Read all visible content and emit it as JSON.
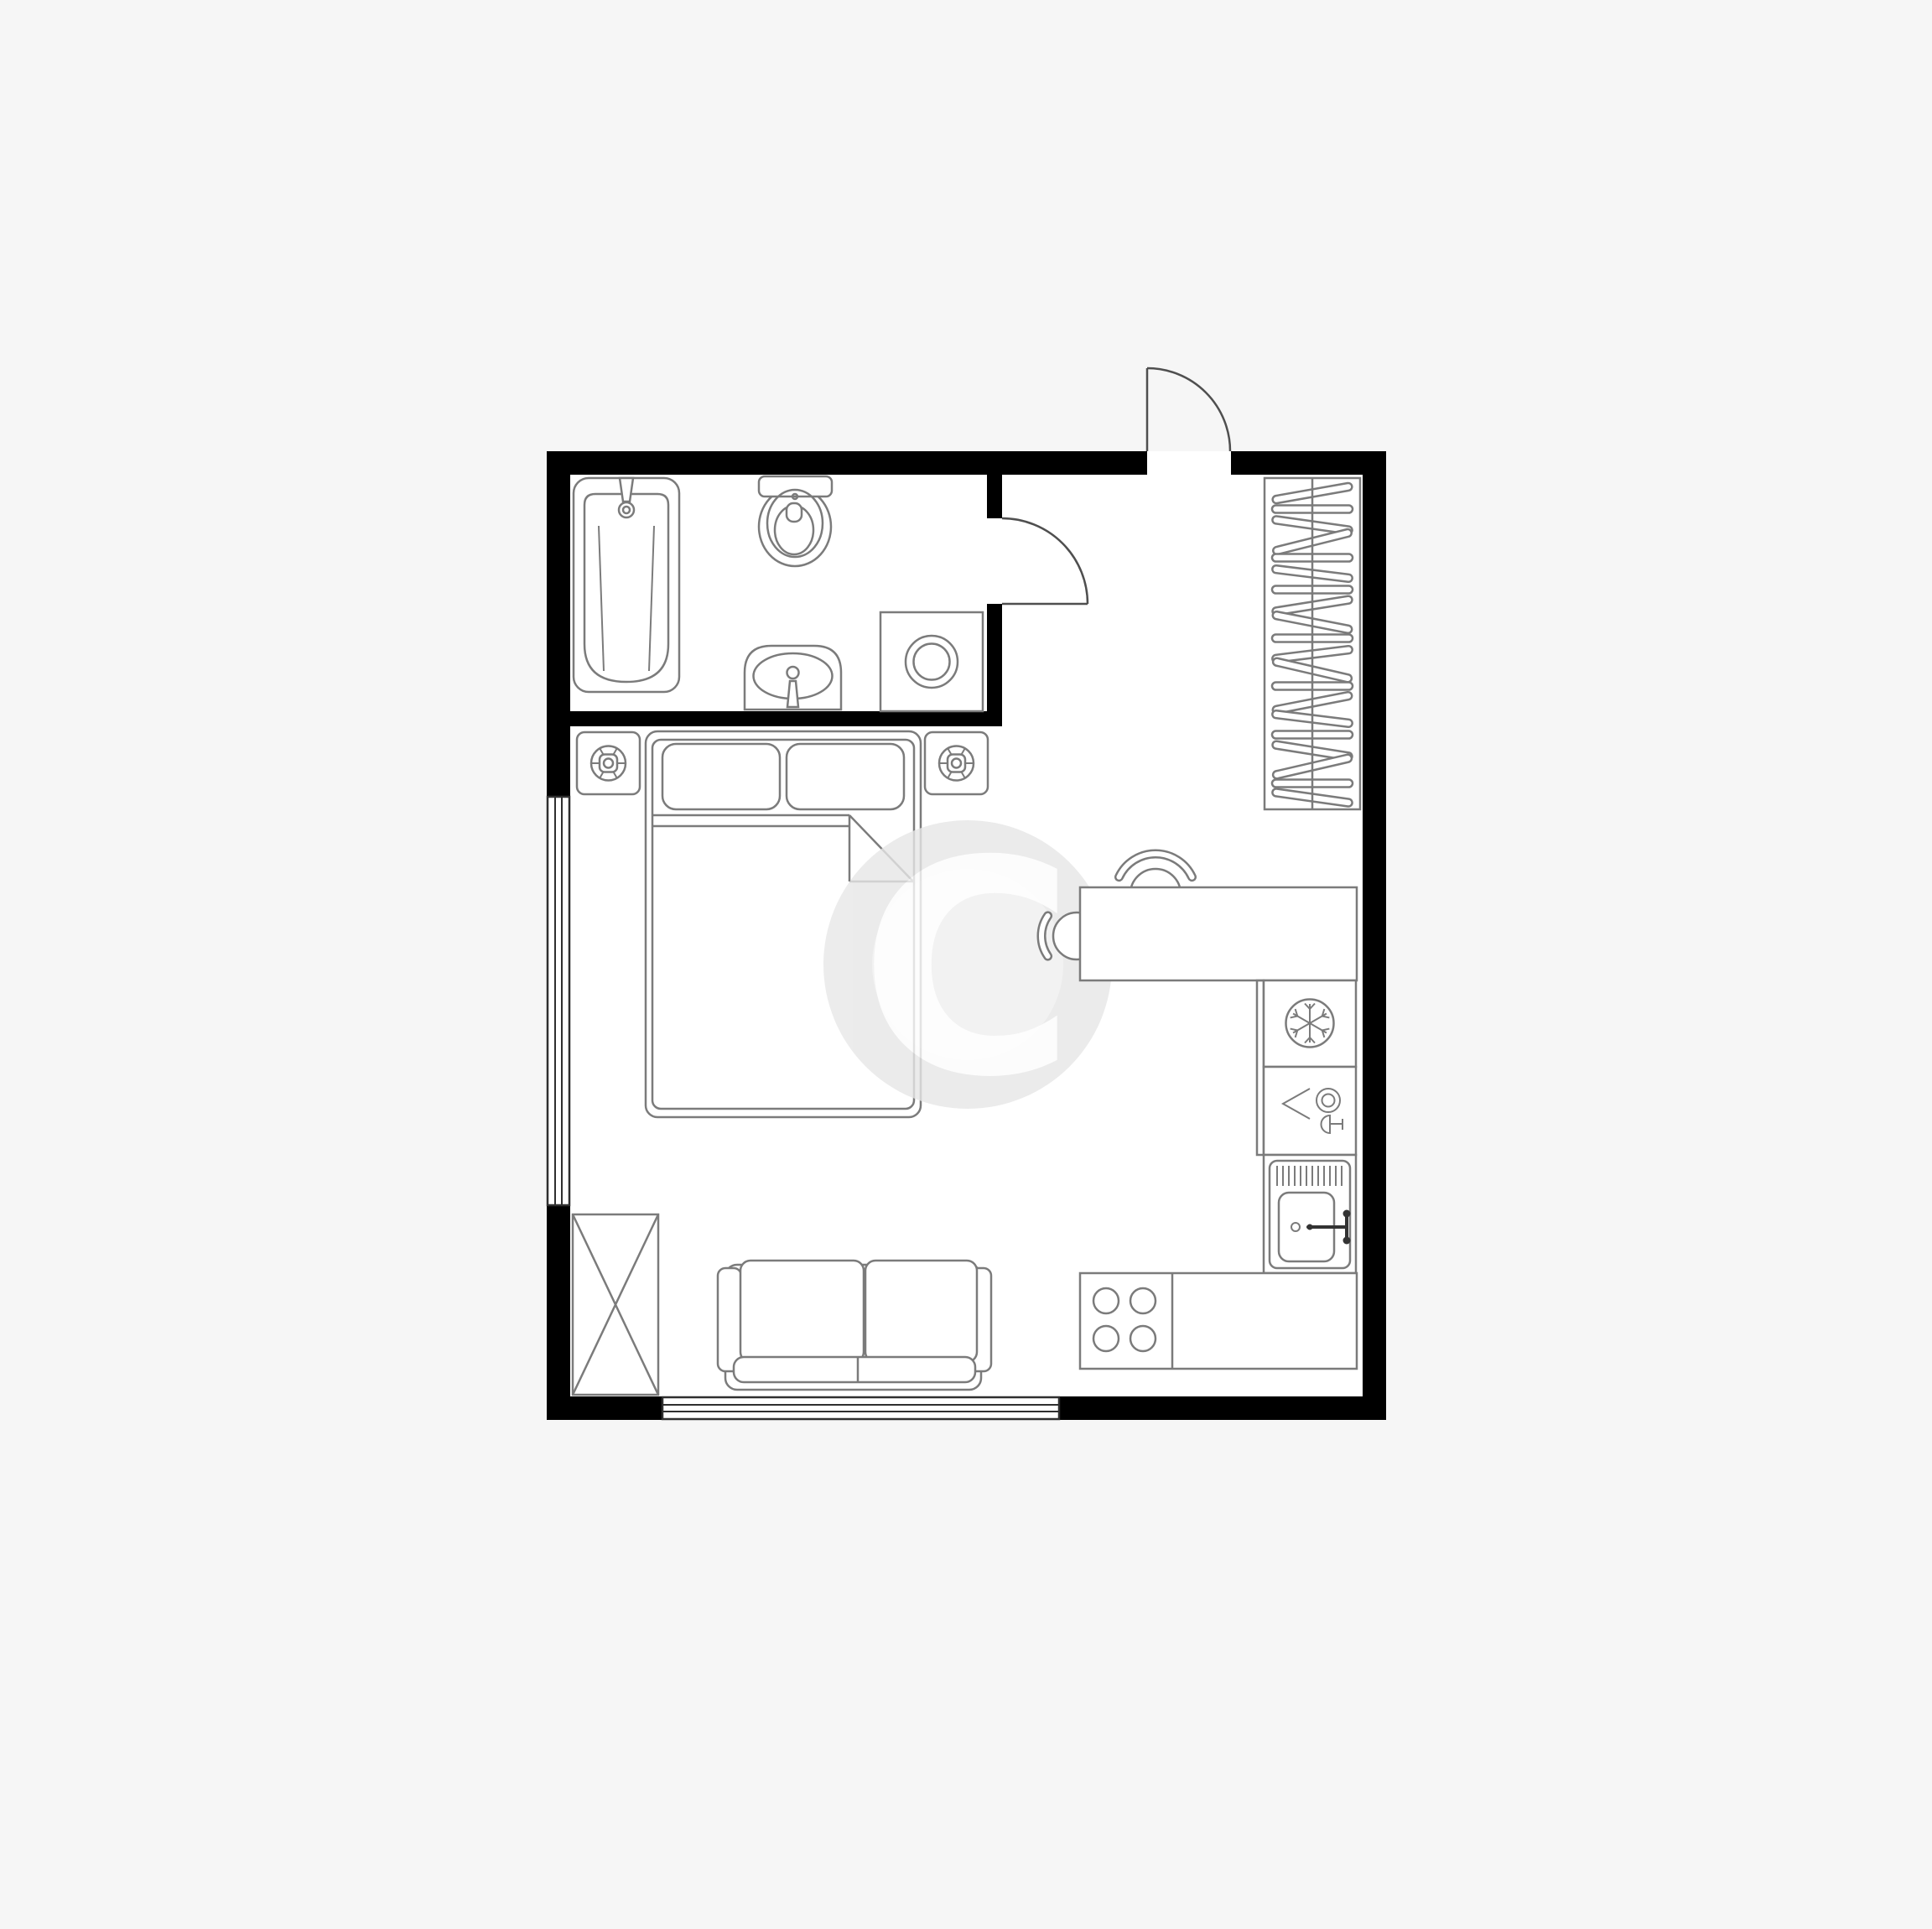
{
  "page": {
    "type": "apartment-floor-plan",
    "background_color": "#f6f6f6",
    "floor_color": "#ffffff",
    "wall_color": "#000000",
    "furniture_stroke_color": "#7b7b7b",
    "door_stroke_color": "#4f4f4f",
    "window_stroke_color": "#2f2f2f",
    "detail_stroke_color": "#333333"
  },
  "watermark": {
    "letter": "C",
    "ring_color": "#e7e7e7",
    "core_color": "#f0f0f0",
    "letter_color": "#ffffff"
  },
  "rooms": [
    {
      "name": "bathroom",
      "position": "top-left"
    },
    {
      "name": "hallway",
      "position": "top-right"
    },
    {
      "name": "living-sleeping-room",
      "position": "center-left"
    },
    {
      "name": "kitchen-zone",
      "position": "right"
    }
  ],
  "fixtures": [
    {
      "name": "bathtub",
      "icon": "bathtub-icon",
      "room": "bathroom"
    },
    {
      "name": "bath-faucet",
      "icon": "faucet-icon",
      "room": "bathroom"
    },
    {
      "name": "toilet",
      "icon": "toilet-icon",
      "room": "bathroom"
    },
    {
      "name": "washbasin",
      "icon": "washbasin-icon",
      "room": "bathroom"
    },
    {
      "name": "washing-machine",
      "icon": "washing-machine-icon",
      "room": "bathroom"
    },
    {
      "name": "bathroom-door",
      "icon": "door-swing-icon",
      "room": "bathroom"
    },
    {
      "name": "entry-door",
      "icon": "door-swing-icon",
      "room": "hallway"
    },
    {
      "name": "hanger-wardrobe",
      "icon": "clothes-hangers-icon",
      "room": "hallway"
    },
    {
      "name": "double-bed",
      "icon": "bed-icon",
      "room": "living-sleeping-room"
    },
    {
      "name": "pillow",
      "count": 2,
      "icon": "pillow-icon",
      "room": "living-sleeping-room"
    },
    {
      "name": "nightstand-with-lamp",
      "count": 2,
      "icon": "table-lamp-icon",
      "room": "living-sleeping-room"
    },
    {
      "name": "storage-wardrobe-crossed",
      "icon": "crossed-box-icon",
      "room": "living-sleeping-room"
    },
    {
      "name": "sofa",
      "icon": "sofa-icon",
      "room": "living-sleeping-room"
    },
    {
      "name": "window-left",
      "icon": "window-icon",
      "room": "living-sleeping-room"
    },
    {
      "name": "window-bottom",
      "icon": "window-icon",
      "room": "living-sleeping-room"
    },
    {
      "name": "desk",
      "icon": "table-icon",
      "room": "kitchen-zone"
    },
    {
      "name": "chair",
      "count": 2,
      "icon": "chair-icon",
      "room": "kitchen-zone"
    },
    {
      "name": "refrigerator",
      "icon": "snowflake-icon",
      "room": "kitchen-zone"
    },
    {
      "name": "dishwasher",
      "icon": "plate-and-glass-icon",
      "room": "kitchen-zone"
    },
    {
      "name": "kitchen-sink",
      "icon": "sink-faucet-icon",
      "room": "kitchen-zone"
    },
    {
      "name": "stove",
      "icon": "four-burners-icon",
      "room": "kitchen-zone"
    },
    {
      "name": "kitchen-counter",
      "icon": "counter-icon",
      "room": "kitchen-zone"
    }
  ]
}
